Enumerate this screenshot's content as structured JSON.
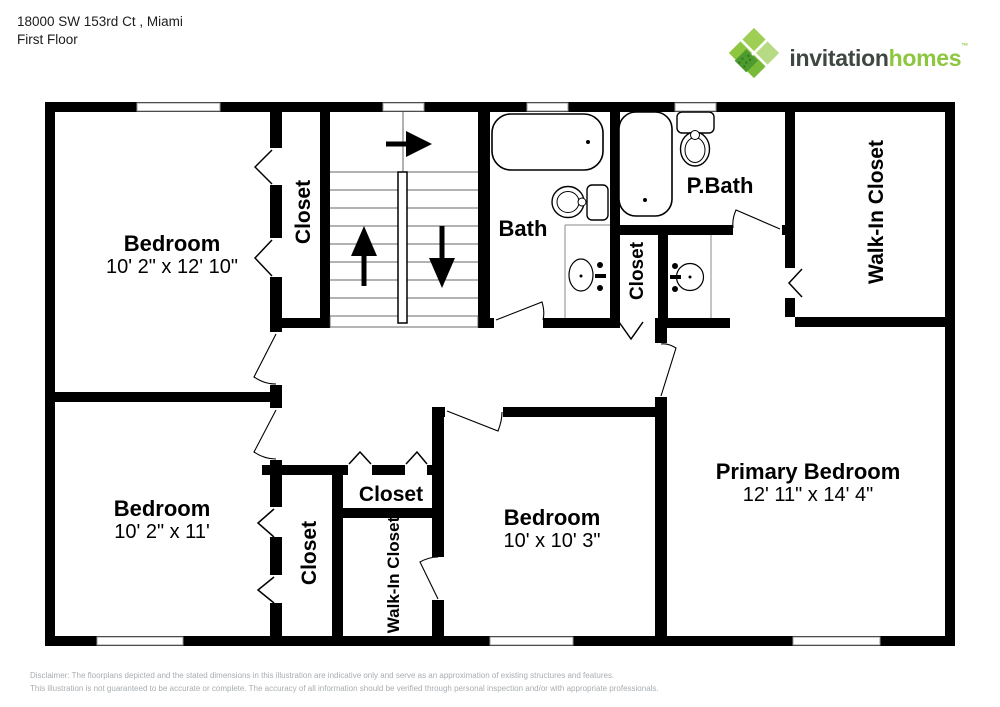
{
  "header": {
    "address": "18000 SW 153rd Ct , Miami",
    "floor": "First Floor"
  },
  "logo": {
    "word1": "invitation",
    "word2": "homes",
    "trademark": "™",
    "colors": {
      "dark": "#3E4742",
      "green": "#8DC63F",
      "green_light": "#B7DB85",
      "green_dark": "#4D9A2E"
    }
  },
  "rooms": {
    "bedroom_top_left": {
      "name": "Bedroom",
      "dims": "10' 2\" x 12' 10\""
    },
    "closet_top": {
      "label": "Closet"
    },
    "bath": {
      "label": "Bath"
    },
    "primary_bath": {
      "label": "P.Bath"
    },
    "walkin_closet_top": {
      "label": "Walk-In Closet"
    },
    "closet_mid": {
      "label": "Closet"
    },
    "bedroom_bottom_left": {
      "name": "Bedroom",
      "dims": "10' 2\" x 11'"
    },
    "closet_bottom_left": {
      "label": "Closet"
    },
    "closet_bottom": {
      "label": "Closet"
    },
    "walkin_closet_bottom": {
      "label": "Walk-In Closet"
    },
    "bedroom_middle": {
      "name": "Bedroom",
      "dims": "10' x 10' 3\""
    },
    "primary_bedroom": {
      "name": "Primary Bedroom",
      "dims": "12' 11\" x 14' 4\""
    }
  },
  "colors": {
    "wall": "#000000",
    "window_line": "#999999",
    "disclaimer_text": "#A8ADB1"
  },
  "disclaimer": {
    "line1": "Disclaimer: The floorplans depicted and the stated dimensions in this illustration are indicative only and serve as an approximation of existing structures and features.",
    "line2": "This illustration is not guaranteed to be accurate or complete. The accuracy of all information should be verified through personal inspection and/or with appropriate professionals."
  }
}
